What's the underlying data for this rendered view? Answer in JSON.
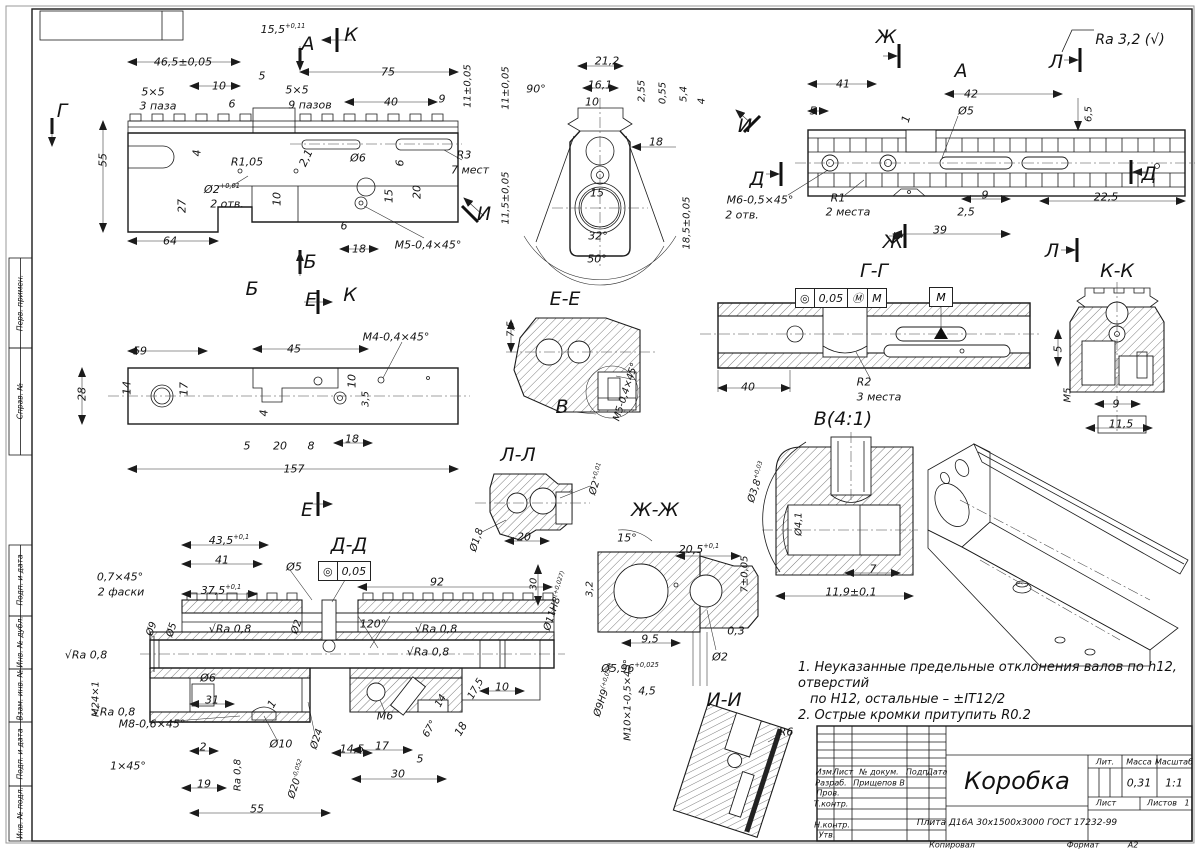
{
  "frame": {
    "kopiroval": "Копировал",
    "format_label": "Формат",
    "format_value": "А2"
  },
  "left_stamp": {
    "labels": [
      "Перв. примен.",
      "Справ. №",
      "Подп. и дата",
      "Инв. № дубл.",
      "Взам. инв. №",
      "Подп. и дата",
      "Инв. № подл."
    ]
  },
  "notes": {
    "line1": "1. Неуказанные предельные отклонения валов по h12, отверстий",
    "line2": "по Н12, остальные – ±IT12/2",
    "line3": "2. Острые кромки притупить R0.2"
  },
  "title_block": {
    "cols": [
      "Изм.",
      "Лист",
      "№ докум.",
      "Подп.",
      "Дата"
    ],
    "rows": [
      {
        "label": "Разраб.",
        "value": "Прищепов В"
      },
      {
        "label": "Пров.",
        "value": ""
      },
      {
        "label": "Т.контр.",
        "value": ""
      },
      {
        "label": "Н.контр.",
        "value": ""
      },
      {
        "label": "Утв.",
        "value": ""
      }
    ],
    "title": "Коробка",
    "material": "Плита Д16А 30х1500х3000 ГОСТ 17232-99",
    "lit_label": "Лит.",
    "mass_label": "Масса",
    "scale_label": "Масштаб",
    "mass": "0,31",
    "scale": "1:1",
    "sheet_label": "Лист",
    "sheets_label": "Листов",
    "sheets_value": "1"
  },
  "tolerance": {
    "g1": {
      "sym": "◎",
      "val": "0,05",
      "mod": "Ⓜ",
      "datum": "M"
    },
    "g2": {
      "sym": "◎",
      "val": "0,05"
    },
    "datum_box": "M"
  },
  "labels": [
    {
      "t": "15,5",
      "sup": "+0,11",
      "x": 283,
      "y": 29
    },
    {
      "t": "46,5±0,05",
      "x": 183,
      "y": 62
    },
    {
      "t": "10",
      "x": 219,
      "y": 86
    },
    {
      "t": "5",
      "x": 262,
      "y": 76
    },
    {
      "t": "75",
      "x": 388,
      "y": 72
    },
    {
      "t": "5×5",
      "x": 153,
      "y": 92
    },
    {
      "t": "3 паза",
      "x": 158,
      "y": 106
    },
    {
      "t": "5×5",
      "x": 297,
      "y": 90
    },
    {
      "t": "9 пазов",
      "x": 310,
      "y": 105
    },
    {
      "t": "6",
      "x": 232,
      "y": 104
    },
    {
      "t": "40",
      "x": 391,
      "y": 102
    },
    {
      "t": "9",
      "x": 442,
      "y": 99
    },
    {
      "t": "11±0,05",
      "x": 468,
      "y": 86,
      "r": -90,
      "fs": 10
    },
    {
      "t": "55",
      "x": 103,
      "y": 160,
      "r": -90
    },
    {
      "t": "4",
      "x": 197,
      "y": 153,
      "r": -90
    },
    {
      "t": "R1,05",
      "x": 247,
      "y": 162
    },
    {
      "t": "2,1",
      "x": 306,
      "y": 158,
      "r": -65
    },
    {
      "t": "Ø6",
      "x": 358,
      "y": 158
    },
    {
      "t": "6",
      "x": 400,
      "y": 163,
      "r": -90
    },
    {
      "t": "R3",
      "x": 464,
      "y": 155
    },
    {
      "t": "7 мест",
      "x": 470,
      "y": 170
    },
    {
      "t": "Ø2",
      "sup": "+0,01",
      "x": 222,
      "y": 189
    },
    {
      "t": "2 отв.",
      "x": 227,
      "y": 204
    },
    {
      "t": "27",
      "x": 182,
      "y": 206,
      "r": -90
    },
    {
      "t": "10",
      "x": 277,
      "y": 199,
      "r": -90
    },
    {
      "t": "15",
      "x": 389,
      "y": 196,
      "r": -90
    },
    {
      "t": "20",
      "x": 417,
      "y": 192,
      "r": -90
    },
    {
      "t": "6",
      "x": 344,
      "y": 226
    },
    {
      "t": "64",
      "x": 170,
      "y": 241
    },
    {
      "t": "18",
      "x": 359,
      "y": 249
    },
    {
      "t": "M5-0,4×45°",
      "x": 428,
      "y": 245
    },
    {
      "t": "Г",
      "x": 62,
      "y": 111,
      "fs": 19
    },
    {
      "t": "А",
      "x": 308,
      "y": 44,
      "fs": 19
    },
    {
      "t": "К",
      "x": 351,
      "y": 35,
      "fs": 19
    },
    {
      "t": "Б",
      "x": 310,
      "y": 262,
      "fs": 19
    },
    {
      "t": "Б",
      "x": 252,
      "y": 289,
      "fs": 19
    },
    {
      "t": "Е",
      "x": 311,
      "y": 300,
      "fs": 19
    },
    {
      "t": "Е",
      "x": 307,
      "y": 510,
      "fs": 19
    },
    {
      "t": "К",
      "x": 350,
      "y": 295,
      "fs": 19
    },
    {
      "t": "И",
      "x": 484,
      "y": 214,
      "fs": 19
    },
    {
      "t": "21,2",
      "x": 607,
      "y": 61
    },
    {
      "t": "16,1",
      "x": 600,
      "y": 85
    },
    {
      "t": "10",
      "x": 592,
      "y": 102
    },
    {
      "t": "90°",
      "x": 536,
      "y": 89
    },
    {
      "t": "2,55",
      "x": 642,
      "y": 91,
      "r": -90,
      "fs": 10
    },
    {
      "t": "0,55",
      "x": 663,
      "y": 93,
      "r": -90,
      "fs": 10
    },
    {
      "t": "5,4",
      "x": 684,
      "y": 94,
      "r": -90,
      "fs": 10
    },
    {
      "t": "4",
      "x": 702,
      "y": 101,
      "r": -90,
      "fs": 10
    },
    {
      "t": "11±0,05",
      "x": 506,
      "y": 88,
      "r": -90,
      "fs": 10
    },
    {
      "t": "18",
      "x": 656,
      "y": 142
    },
    {
      "t": "11,5±0,05",
      "x": 506,
      "y": 198,
      "r": -90,
      "fs": 10
    },
    {
      "t": "15",
      "x": 597,
      "y": 193
    },
    {
      "t": "32°",
      "x": 598,
      "y": 236
    },
    {
      "t": "50°",
      "x": 597,
      "y": 259
    },
    {
      "t": "18,5±0,05",
      "x": 687,
      "y": 223,
      "r": -90,
      "fs": 10
    },
    {
      "t": "Ж",
      "x": 886,
      "y": 37,
      "fs": 19
    },
    {
      "t": "Ж",
      "x": 893,
      "y": 242,
      "fs": 19
    },
    {
      "t": "А",
      "x": 961,
      "y": 71,
      "fs": 19
    },
    {
      "t": "Л",
      "x": 1056,
      "y": 62,
      "fs": 19
    },
    {
      "t": "Л",
      "x": 1052,
      "y": 251,
      "fs": 19
    },
    {
      "t": "Д",
      "x": 757,
      "y": 179,
      "fs": 19
    },
    {
      "t": "Д",
      "x": 1149,
      "y": 174,
      "fs": 19
    },
    {
      "t": "И",
      "x": 745,
      "y": 126,
      "fs": 19
    },
    {
      "t": "Ra 3,2 (√)",
      "x": 1130,
      "y": 40,
      "fs": 14
    },
    {
      "t": "41",
      "x": 843,
      "y": 84
    },
    {
      "t": "5",
      "x": 813,
      "y": 111
    },
    {
      "t": "42",
      "x": 971,
      "y": 94
    },
    {
      "t": "Ø5",
      "x": 966,
      "y": 111
    },
    {
      "t": "1",
      "x": 906,
      "y": 119,
      "r": -75
    },
    {
      "t": "6,5",
      "x": 1089,
      "y": 114,
      "r": -90,
      "fs": 10
    },
    {
      "t": "M6-0,5×45°",
      "x": 760,
      "y": 200
    },
    {
      "t": "2 отв.",
      "x": 742,
      "y": 215
    },
    {
      "t": "R1",
      "x": 838,
      "y": 198
    },
    {
      "t": "2 места",
      "x": 848,
      "y": 212
    },
    {
      "t": "9",
      "x": 985,
      "y": 195
    },
    {
      "t": "2,5",
      "x": 966,
      "y": 212
    },
    {
      "t": "39",
      "x": 940,
      "y": 230
    },
    {
      "t": "22,5",
      "x": 1106,
      "y": 197
    },
    {
      "t": "M4-0,4×45°",
      "x": 396,
      "y": 337
    },
    {
      "t": "59",
      "x": 140,
      "y": 351
    },
    {
      "t": "45",
      "x": 294,
      "y": 349
    },
    {
      "t": "28",
      "x": 82,
      "y": 394,
      "r": -90
    },
    {
      "t": "14",
      "x": 127,
      "y": 388,
      "r": -90
    },
    {
      "t": "17",
      "x": 184,
      "y": 389,
      "r": -90
    },
    {
      "t": "10",
      "x": 352,
      "y": 381,
      "r": -90
    },
    {
      "t": "3,5",
      "x": 366,
      "y": 399,
      "r": -90,
      "fs": 10
    },
    {
      "t": "4",
      "x": 264,
      "y": 413,
      "r": -90
    },
    {
      "t": "5",
      "x": 247,
      "y": 446
    },
    {
      "t": "20",
      "x": 280,
      "y": 446
    },
    {
      "t": "8",
      "x": 311,
      "y": 446
    },
    {
      "t": "18",
      "x": 352,
      "y": 439
    },
    {
      "t": "157",
      "x": 294,
      "y": 469
    },
    {
      "t": "Е-Е",
      "x": 565,
      "y": 299,
      "fs": 19
    },
    {
      "t": "7,5",
      "x": 511,
      "y": 329,
      "r": -90,
      "fs": 10
    },
    {
      "t": "В",
      "x": 562,
      "y": 407,
      "fs": 19
    },
    {
      "t": "M5-0,4×45°",
      "x": 626,
      "y": 392,
      "r": -72,
      "fs": 10
    },
    {
      "t": "Г-Г",
      "x": 874,
      "y": 271,
      "fs": 19
    },
    {
      "t": "40",
      "x": 748,
      "y": 387
    },
    {
      "t": "R2",
      "x": 864,
      "y": 382
    },
    {
      "t": "3 места",
      "x": 879,
      "y": 397
    },
    {
      "t": "К-К",
      "x": 1117,
      "y": 271,
      "fs": 19
    },
    {
      "t": "5",
      "x": 1058,
      "y": 349,
      "r": -90
    },
    {
      "t": "M5",
      "x": 1068,
      "y": 395,
      "r": -90,
      "fs": 10
    },
    {
      "t": "9",
      "x": 1116,
      "y": 404
    },
    {
      "t": "11,5",
      "x": 1121,
      "y": 424
    },
    {
      "t": "В(4:1)",
      "x": 843,
      "y": 419,
      "fs": 19
    },
    {
      "t": "Ø3,8",
      "sup": "+0,03",
      "x": 757,
      "y": 482,
      "r": -72,
      "fs": 10
    },
    {
      "t": "Ø4,1",
      "x": 799,
      "y": 524,
      "r": -90,
      "fs": 10
    },
    {
      "t": "7",
      "x": 873,
      "y": 569
    },
    {
      "t": "11,9±0,1",
      "x": 851,
      "y": 592
    },
    {
      "t": "Л-Л",
      "x": 518,
      "y": 455,
      "fs": 19
    },
    {
      "t": "Ø2",
      "sup": "+0,01",
      "x": 597,
      "y": 479,
      "r": -72,
      "fs": 10
    },
    {
      "t": "Ø1,8",
      "x": 477,
      "y": 540,
      "r": -72,
      "fs": 10
    },
    {
      "t": "20",
      "x": 524,
      "y": 537
    },
    {
      "t": "Ж-Ж",
      "x": 655,
      "y": 510,
      "fs": 19
    },
    {
      "t": "15°",
      "x": 627,
      "y": 538
    },
    {
      "t": "20,5",
      "sup": "+0,1",
      "x": 699,
      "y": 549
    },
    {
      "t": "7±0,05",
      "x": 745,
      "y": 574,
      "r": -90,
      "fs": 10
    },
    {
      "t": "3,2",
      "x": 590,
      "y": 589,
      "r": -90,
      "fs": 10
    },
    {
      "t": "9,5",
      "x": 650,
      "y": 639
    },
    {
      "t": "0,3",
      "x": 736,
      "y": 631
    },
    {
      "t": "Ø2",
      "x": 720,
      "y": 657
    },
    {
      "t": "Ø5,96",
      "sup": "+0,025",
      "x": 630,
      "y": 668
    },
    {
      "t": "4,5",
      "x": 647,
      "y": 691
    },
    {
      "t": "Д-Д",
      "x": 349,
      "y": 545,
      "fs": 19
    },
    {
      "t": "43,5",
      "sup": "+0,1",
      "x": 229,
      "y": 540
    },
    {
      "t": "41",
      "x": 222,
      "y": 560
    },
    {
      "t": "Ø5",
      "x": 294,
      "y": 567
    },
    {
      "t": "92",
      "x": 437,
      "y": 582
    },
    {
      "t": "0,7×45°",
      "x": 120,
      "y": 577
    },
    {
      "t": "2 фаски",
      "x": 121,
      "y": 592
    },
    {
      "t": "37,5",
      "sup": "+0,1",
      "x": 221,
      "y": 590
    },
    {
      "t": "30",
      "x": 534,
      "y": 584,
      "r": -90,
      "fs": 10
    },
    {
      "t": "Ø11Н8",
      "sup": "(+0,027)",
      "x": 556,
      "y": 601,
      "r": -72,
      "fs": 10
    },
    {
      "t": "√Ra 0,8",
      "x": 230,
      "y": 629
    },
    {
      "t": "Ø2",
      "x": 297,
      "y": 627,
      "r": -72,
      "fs": 10
    },
    {
      "t": "120°",
      "x": 373,
      "y": 624
    },
    {
      "t": "√Ra 0,8",
      "x": 436,
      "y": 629
    },
    {
      "t": "√Ra 0,8",
      "x": 428,
      "y": 652
    },
    {
      "t": "Ø9",
      "x": 152,
      "y": 629,
      "r": -72,
      "fs": 10
    },
    {
      "t": "Ø5",
      "x": 172,
      "y": 630,
      "r": -72,
      "fs": 10
    },
    {
      "t": "√Ra 0,8",
      "x": 86,
      "y": 655
    },
    {
      "t": "M24×1",
      "x": 96,
      "y": 699,
      "r": -90,
      "fs": 10
    },
    {
      "t": "Ø6",
      "x": 208,
      "y": 678
    },
    {
      "t": "31",
      "x": 212,
      "y": 700
    },
    {
      "t": "1",
      "x": 272,
      "y": 704,
      "r": -60
    },
    {
      "t": "√Ra 0,8",
      "x": 114,
      "y": 712
    },
    {
      "t": "M8-0,6×45°",
      "x": 152,
      "y": 724
    },
    {
      "t": "2",
      "x": 203,
      "y": 747
    },
    {
      "t": "Ø10",
      "x": 281,
      "y": 744
    },
    {
      "t": "1×45°",
      "x": 128,
      "y": 766
    },
    {
      "t": "19",
      "x": 204,
      "y": 784
    },
    {
      "t": "Ra 0,8",
      "x": 238,
      "y": 775,
      "r": -90,
      "fs": 10
    },
    {
      "t": "Ø20",
      "sup": "-0,052",
      "x": 297,
      "y": 779,
      "r": -72,
      "fs": 10
    },
    {
      "t": "55",
      "x": 257,
      "y": 809
    },
    {
      "t": "Ø24",
      "x": 317,
      "y": 739,
      "r": -72,
      "fs": 10
    },
    {
      "t": "14,5",
      "x": 352,
      "y": 749
    },
    {
      "t": "M6",
      "x": 385,
      "y": 716
    },
    {
      "t": "17",
      "x": 382,
      "y": 746
    },
    {
      "t": "5",
      "x": 420,
      "y": 759
    },
    {
      "t": "30",
      "x": 398,
      "y": 774
    },
    {
      "t": "67°",
      "x": 430,
      "y": 729,
      "r": -60,
      "fs": 10
    },
    {
      "t": "18",
      "x": 461,
      "y": 729,
      "r": -60
    },
    {
      "t": "14",
      "x": 441,
      "y": 701,
      "r": -60,
      "fs": 10
    },
    {
      "t": "17,5",
      "x": 476,
      "y": 689,
      "r": -60,
      "fs": 10
    },
    {
      "t": "10",
      "x": 502,
      "y": 687
    },
    {
      "t": "Ø9Н9",
      "sup": "(+0,036)",
      "x": 605,
      "y": 690,
      "r": -72,
      "fs": 10
    },
    {
      "t": "M10×1-0,5×45°",
      "x": 628,
      "y": 700,
      "r": -90,
      "fs": 10
    },
    {
      "t": "И-И",
      "x": 724,
      "y": 700,
      "fs": 19
    },
    {
      "t": "R6",
      "x": 786,
      "y": 732
    }
  ]
}
